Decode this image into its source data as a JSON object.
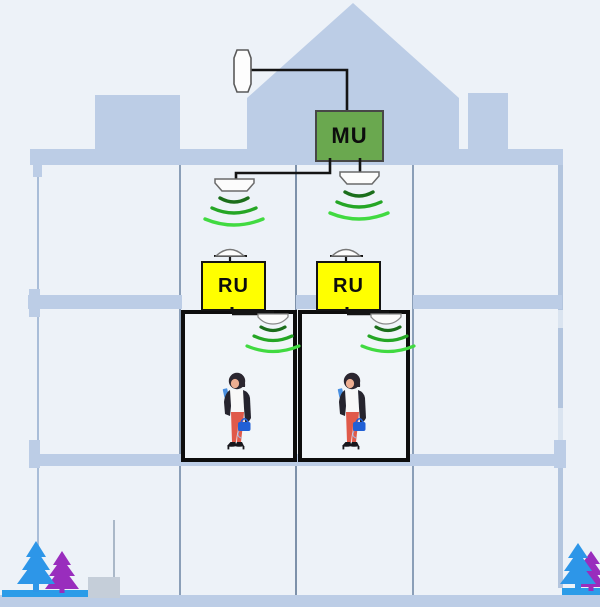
{
  "labels": {
    "master_unit": "MU",
    "remote_unit_1": "RU",
    "remote_unit_2": "RU"
  },
  "palette": {
    "background": "#edf2f8",
    "building_blue": "#bccde6",
    "master_unit_fill": "#6aa84f",
    "remote_unit_fill": "#ffff00",
    "cable_black": "#141414",
    "room_border": "#0d0d0d",
    "signal_wave_greens": [
      "#1b6e1b",
      "#25a625",
      "#41da41"
    ],
    "tree_blue": "#2d96e8",
    "tree_purple": "#992dbd",
    "tree_base_blue": "#2b9ce8"
  },
  "icons": [
    "roof-antenna-icon",
    "ceiling-antenna-icon",
    "dome-antenna-icon",
    "signal-waves-icon",
    "person-with-phone-icon",
    "tree-icon"
  ]
}
